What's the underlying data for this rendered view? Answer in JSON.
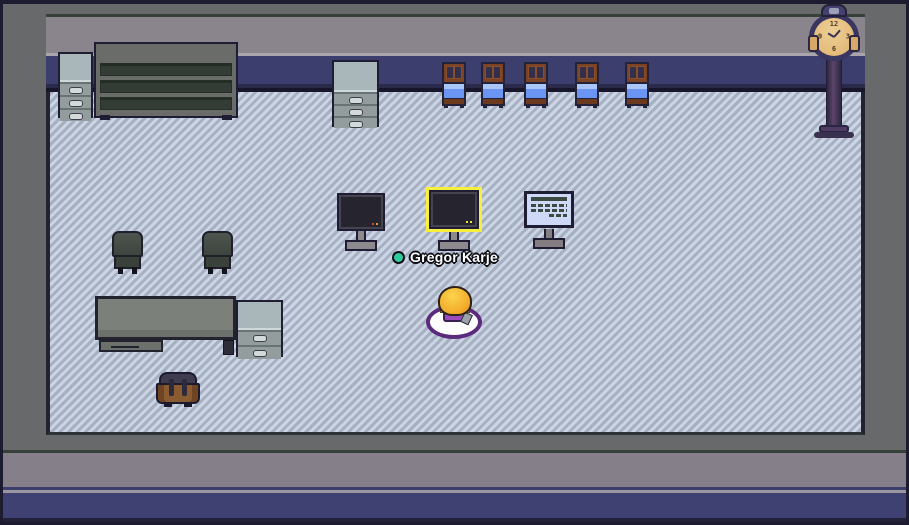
{
  "scene": {
    "title": "top-down pixel-art office room",
    "player": {
      "name": "Gregor Karje",
      "status_dot_color": "#2ecc9e"
    },
    "selection": {
      "selected_object": "center-monitor",
      "highlight_color": "#f6ef3e"
    }
  },
  "clock_face": {
    "n12": "12",
    "n3": "3",
    "n6": "6",
    "n9": "9"
  },
  "colors": {
    "wall_navy": "#3c3e6e",
    "wall_gray": "#8a858d",
    "floor_light": "#cbd5e5",
    "floor_dark": "#a7b0c1",
    "outer_margin": "#67696a",
    "outline_dark": "#1e1d33"
  }
}
